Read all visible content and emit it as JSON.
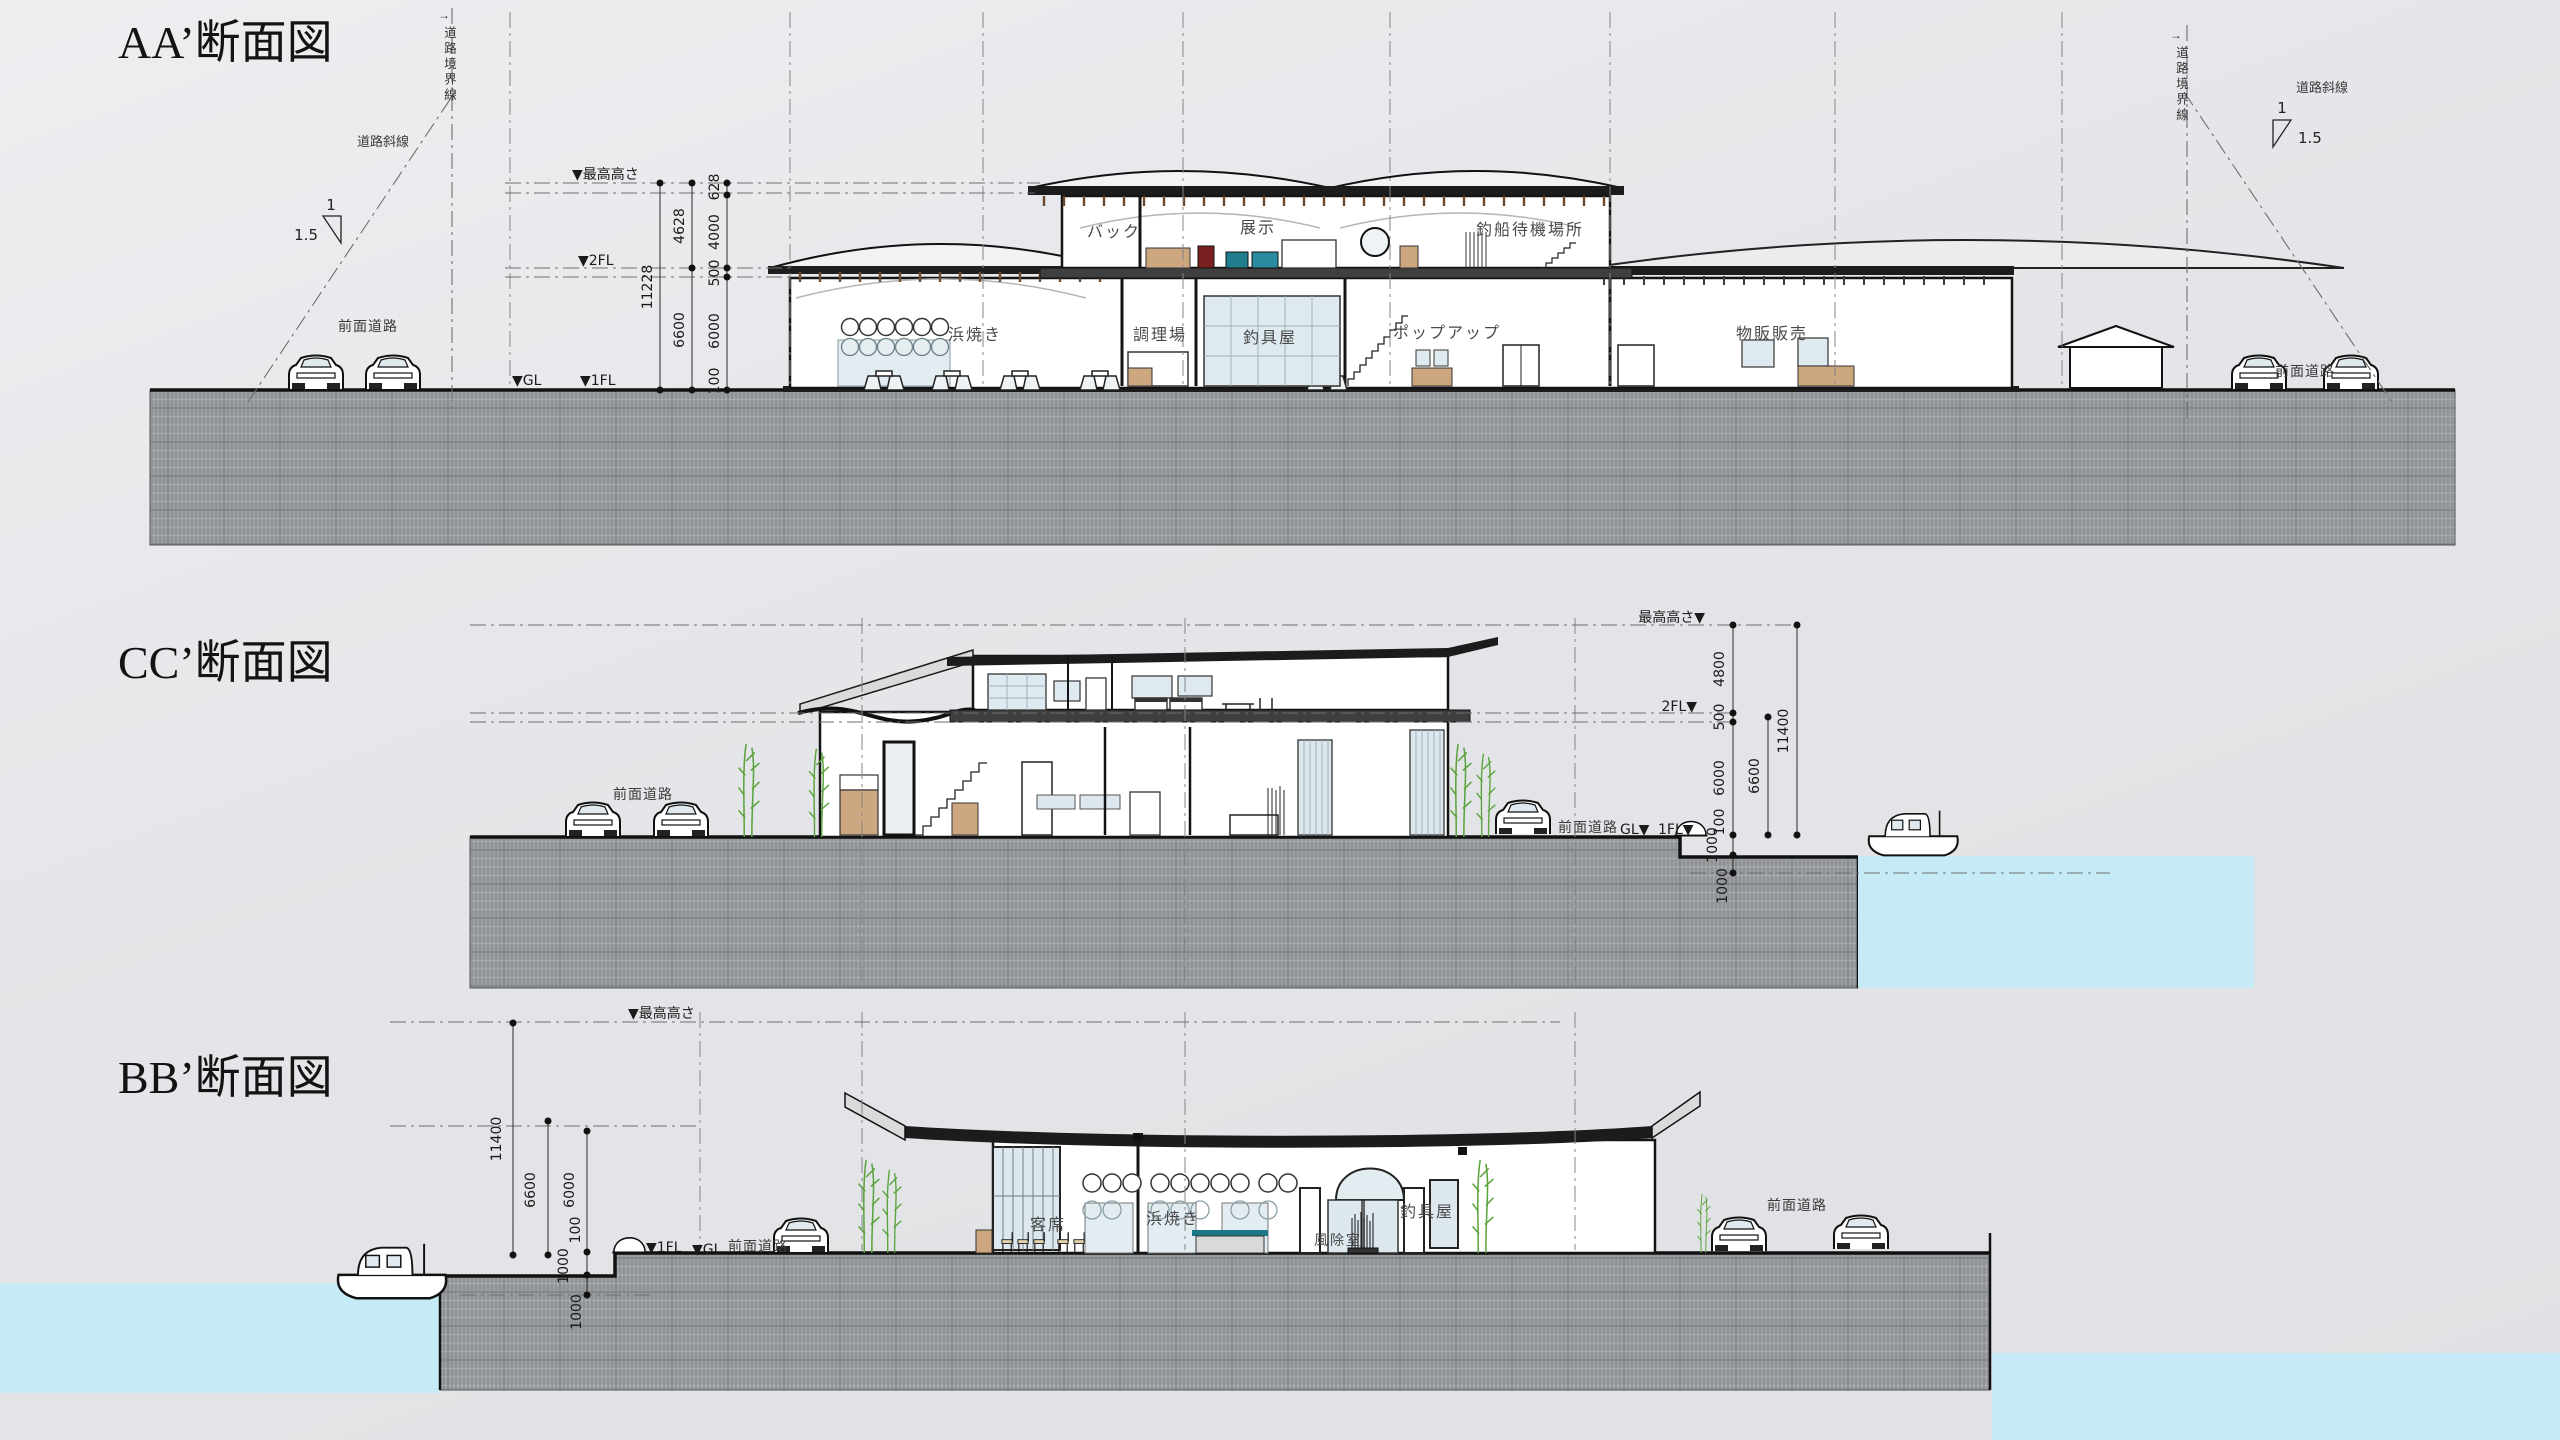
{
  "aa": {
    "title": "AA’断面図",
    "boundary_left": {
      "arrow": "→",
      "label": "道路境界線"
    },
    "boundary_right": {
      "arrow": "→",
      "label": "道路境界線"
    },
    "slant_left": {
      "label": "道路斜線",
      "rise": "1",
      "run": "1.5"
    },
    "slant_right": {
      "label": "道路斜線",
      "rise": "1",
      "run": "1.5"
    },
    "road_left": "前面道路",
    "road_right": "前面道路",
    "lv_max": "▼最高高さ",
    "lv_2fl": "▼2FL",
    "lv_gl": "▼GL",
    "lv_1fl": "▼1FL",
    "d_total": "11228",
    "d_upper": "4628",
    "d_lower": "6600",
    "d_628": "628",
    "d_4000": "4000",
    "d_500": "500",
    "d_6000": "6000",
    "d_100": "100",
    "rm_back": "バック",
    "rm_tenji": "展示",
    "rm_machi": "釣船待機場所",
    "rm_hama": "浜焼き",
    "rm_chouri": "調理場",
    "rm_tsurigu": "釣具屋",
    "rm_popup": "ポップアップ",
    "rm_buppan": "物販販売"
  },
  "cc": {
    "title": "CC’断面図",
    "lv_max": "最高高さ▼",
    "lv_2fl": "2FL▼",
    "lv_gl": "GL▼",
    "lv_1fl": "1FL▼",
    "road_left": "前面道路",
    "road_right": "前面道路",
    "d_4800": "4800",
    "d_500": "500",
    "d_6000": "6000",
    "d_100": "100",
    "d_1000a": "1000",
    "d_1000b": "1000",
    "d_6600": "6600",
    "d_11400": "11400"
  },
  "bb": {
    "title": "BB’断面図",
    "lv_max": "▼最高高さ",
    "lv_1fl": "▼1FL",
    "lv_gl": "▼GL",
    "road_left": "前面道路",
    "road_right": "前面道路",
    "d_11400": "11400",
    "d_6600": "6600",
    "d_6000": "6000",
    "d_100": "100",
    "d_1000a": "1000",
    "d_1000b": "1000",
    "rm_kyaku": "客席",
    "rm_hama": "浜焼き",
    "rm_fujo": "風除室",
    "rm_tsurigu": "釣具屋"
  }
}
